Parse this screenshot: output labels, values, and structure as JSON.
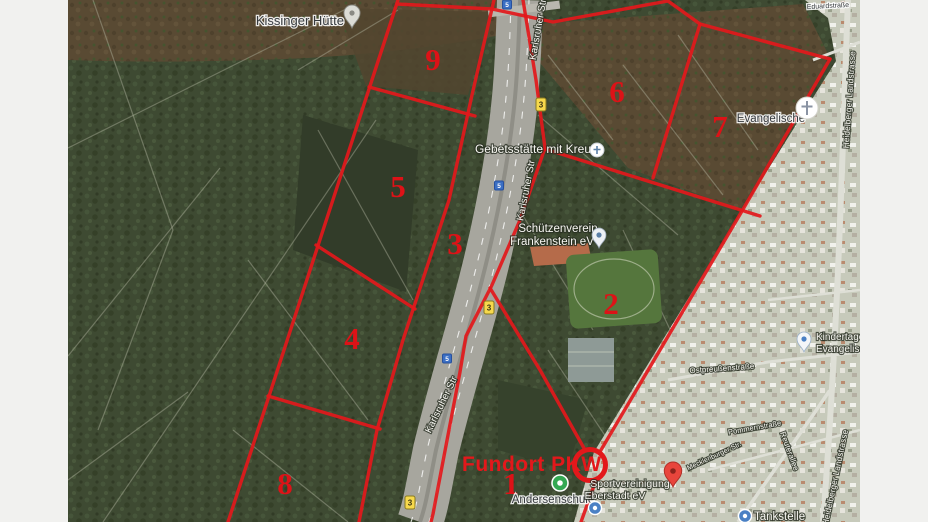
{
  "window": {
    "background_color": "#f1f1ef"
  },
  "map": {
    "overlay_color": "#e3181b",
    "annotations": {
      "fundort_label": "Fundort PKW",
      "regions": [
        {
          "id": "1"
        },
        {
          "id": "2"
        },
        {
          "id": "3"
        },
        {
          "id": "4"
        },
        {
          "id": "5"
        },
        {
          "id": "6"
        },
        {
          "id": "7"
        },
        {
          "id": "8"
        },
        {
          "id": "9"
        }
      ]
    },
    "badges": {
      "b3": "3",
      "a5": "5"
    },
    "pois": {
      "kissinger": {
        "label": "Kissinger Hütte"
      },
      "gebetsstaette": {
        "label": "Gebetsstätte mit Kreuz"
      },
      "schuetzenverein": {
        "line1": "Schützenverein",
        "line2": "Frankenstein eV"
      },
      "evangelische": {
        "label": "Evangelische"
      },
      "kindertagesstaette": {
        "line1": "Kindertage",
        "line2": "Evangelisc"
      },
      "andersenschule": {
        "label": "Andersenschule"
      },
      "sportvereinigung": {
        "line1": "Sportvereinigung",
        "line2": "Eberstadt eV"
      },
      "tankstelle": {
        "label": "Tankstelle"
      }
    },
    "streets": {
      "karlsruher": "Karlsruher Str",
      "heidelberger": "Heidelberger Landstrasse",
      "ostpreussen": "Ostpreußenstraße",
      "pommern": "Pommernstraße",
      "reuterallee": "Reuterallee",
      "mecklenburger": "Mecklenburger Str.",
      "eduard": "Eduardstraße"
    }
  }
}
